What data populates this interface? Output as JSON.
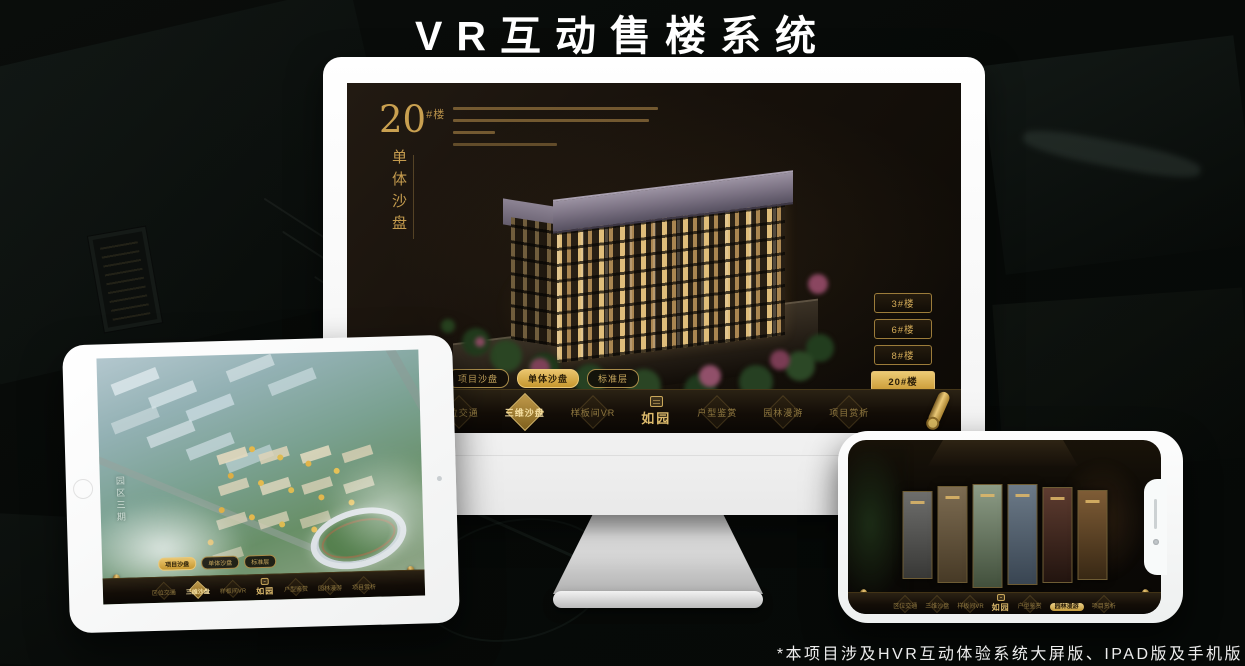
{
  "title": "VR互动售楼系统",
  "footnote": "*本项目涉及HVR互动体验系统大屏版、IPAD版及手机版",
  "colors": {
    "accent_gold": "#c9a050",
    "accent_gold_bright": "#ecca74",
    "screen_dark": "#140f08",
    "device_white": "#fdfdfd",
    "background": "#070a08"
  },
  "icons": {
    "nav_logo_seal": "seal-stamp-icon",
    "nav_end": "scroll-roll-icon",
    "nav_item_backdrop": "diamond-emblem-icon",
    "tablet_home": "home-button-icon",
    "tablet_camera": "camera-dot-icon",
    "phone_speaker": "speaker-slit-icon",
    "phone_camera": "camera-dot-icon"
  },
  "monitor": {
    "heading": {
      "number": "20",
      "suffix": "#楼",
      "page_name": "单体沙盘"
    },
    "floor_buttons": [
      {
        "label": "3#楼",
        "active": false
      },
      {
        "label": "6#楼",
        "active": false
      },
      {
        "label": "8#楼",
        "active": false
      },
      {
        "label": "20#楼",
        "active": true
      }
    ],
    "sub_tabs": [
      {
        "label": "项目沙盘",
        "active": false
      },
      {
        "label": "单体沙盘",
        "active": true
      },
      {
        "label": "标准层",
        "active": false
      }
    ],
    "nav": {
      "items_left": [
        "区位交通",
        "三维沙盘",
        "样板间VR"
      ],
      "logo": "如园",
      "items_right": [
        "户型鉴赏",
        "园林漫游",
        "项目赏析"
      ],
      "active": "三维沙盘"
    }
  },
  "tablet": {
    "zone_label": "园区三期",
    "sub_tabs": [
      {
        "label": "项目沙盘",
        "active": true
      },
      {
        "label": "单体沙盘",
        "active": false
      },
      {
        "label": "标准层",
        "active": false
      }
    ],
    "nav": {
      "items_left": [
        "区位交通",
        "三维沙盘",
        "样板间VR"
      ],
      "logo": "如园",
      "items_right": [
        "户型鉴赏",
        "园林漫游",
        "项目赏析"
      ],
      "active": "三维沙盘"
    }
  },
  "phone": {
    "nav": {
      "items_left": [
        "区位交通",
        "三维沙盘",
        "样板间VR"
      ],
      "logo": "如园",
      "items_right": [
        "户型鉴赏",
        "园林漫游",
        "项目赏析"
      ],
      "active": "园林漫游"
    }
  }
}
